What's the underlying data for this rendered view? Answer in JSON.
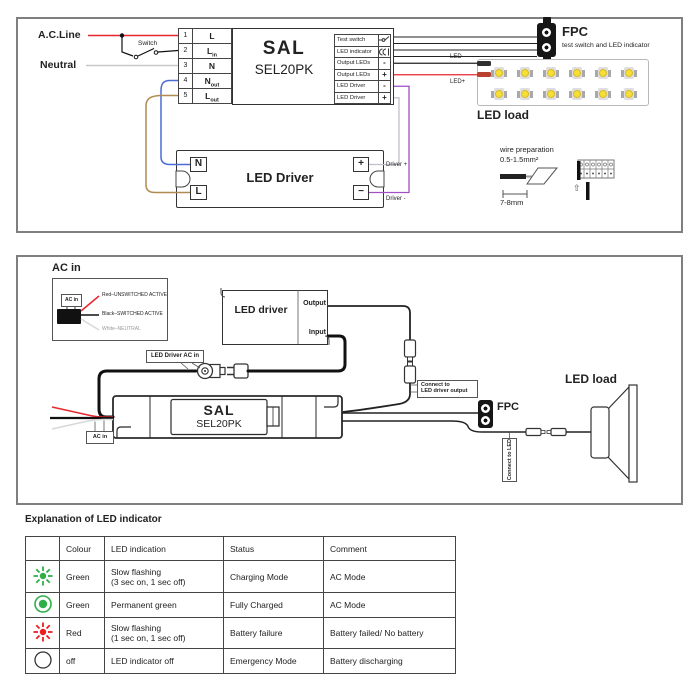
{
  "panel1": {
    "ac_line_label": "A.C.Line",
    "switch_label": "Switch",
    "neutral_label": "Neutral",
    "terminal_block": {
      "rows": [
        {
          "num": "1",
          "base": "L",
          "sub": ""
        },
        {
          "num": "2",
          "base": "L",
          "sub": "in"
        },
        {
          "num": "3",
          "base": "N",
          "sub": ""
        },
        {
          "num": "4",
          "base": "N",
          "sub": "out"
        },
        {
          "num": "5",
          "base": "L",
          "sub": "out"
        }
      ]
    },
    "unit": {
      "brand": "SAL",
      "model": "SEL20PK"
    },
    "ports": [
      {
        "label": "Test switch",
        "pin": ""
      },
      {
        "label": "LED indicator",
        "pin": ""
      },
      {
        "label": "Output LEDs",
        "pin": "-"
      },
      {
        "label": "Output LEDs",
        "pin": "+"
      },
      {
        "label": "LED Driver",
        "pin": "-"
      },
      {
        "label": "LED Driver",
        "pin": "+"
      }
    ],
    "fpc": {
      "title": "FPC",
      "subtitle": "test switch and LED indicator"
    },
    "led_load": {
      "label": "LED load",
      "wire_neg": "LED-",
      "wire_pos": "LED+"
    },
    "driver": {
      "title": "LED Driver",
      "n": "N",
      "l": "L",
      "plus": "+",
      "minus": "−",
      "out_pos": "Driver +",
      "out_neg": "Driver -"
    },
    "wire_prep": {
      "line1": "wire preparation",
      "line2": "0.5-1.5mm²",
      "length": "7-8mm",
      "insert_arrow": "⇧"
    }
  },
  "panel2": {
    "ac_in_title": "AC in",
    "ac_in_connector": "AC in",
    "lead_red": "Red–UNSWITCHED ACTIVE",
    "lead_black": "Black–SWITCHED ACTIVE",
    "lead_white": "White–NEUTRAL",
    "driver": {
      "title": "LED driver",
      "output": "Output",
      "input": "Input"
    },
    "driver_ac_in_label": "LED Driver AC in",
    "connect_driver_line1": "Connect to",
    "connect_driver_line2": "LED driver output",
    "unit": {
      "brand": "SAL",
      "model": "SEL20PK",
      "ac_in": "AC in"
    },
    "fpc_label": "FPC",
    "connect_led_label": "Connect to LED",
    "led_load_label": "LED load"
  },
  "table": {
    "title": "Explanation of LED indicator",
    "headers": [
      "",
      "Colour",
      "LED indication",
      "Status",
      "Comment"
    ],
    "rows": [
      {
        "icon": "green-flashing-led",
        "colour": "Green",
        "indication": "Slow flashing\n(3 sec on, 1 sec off)",
        "status": "Charging Mode",
        "comment": "AC Mode"
      },
      {
        "icon": "green-solid-led",
        "colour": "Green",
        "indication": "Permanent green",
        "status": "Fully Charged",
        "comment": "AC Mode"
      },
      {
        "icon": "red-flashing-led",
        "colour": "Red",
        "indication": "Slow flashing\n(1 sec on, 1 sec off)",
        "status": "Battery failure",
        "comment": "Battery failed/ No battery"
      },
      {
        "icon": "led-off",
        "colour": "off",
        "indication": "LED indicator off",
        "status": "Emergency Mode",
        "comment": "Battery discharging"
      }
    ]
  },
  "icons": {
    "fpc": "dual-hole-connector",
    "test_switch": "push-switch",
    "led_indicator": "led",
    "table_row_icons": [
      "green-flashing-led",
      "green-solid-led",
      "red-flashing-led",
      "led-off"
    ]
  },
  "colors": {
    "active_red": "#e8262d",
    "neutral_grey": "#c8c8c8",
    "wire_blue": "#4a6bd6",
    "wire_brown": "#b08a50",
    "wire_purple": "#a04fc4",
    "wire_grey": "#c2bfca",
    "led_yellow": "#f6df35",
    "indicator_green": "#2fae4a",
    "indicator_red": "#ed1c24"
  }
}
